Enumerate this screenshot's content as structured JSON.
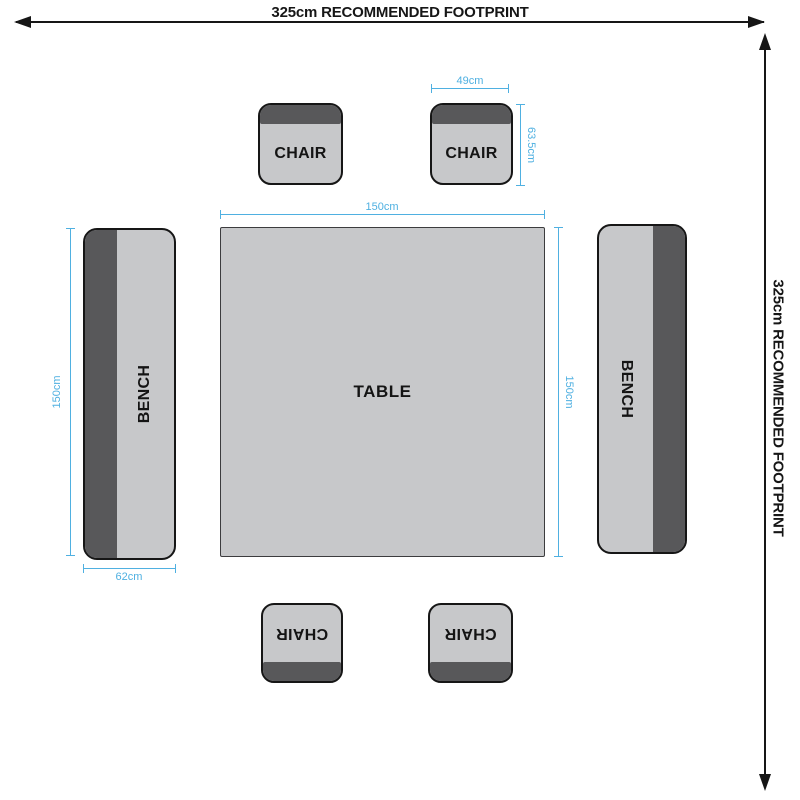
{
  "diagram": {
    "footprint": {
      "top": "325cm RECOMMENDED FOOTPRINT",
      "right": "325cm RECOMMENDED FOOTPRINT"
    },
    "furniture": {
      "table": "TABLE",
      "bench_left": "BENCH",
      "bench_right": "BENCH",
      "chair_top_left": "CHAIR",
      "chair_top_right": "CHAIR",
      "chair_bottom_left": "CHAIR",
      "chair_bottom_right": "CHAIR"
    },
    "dimensions": {
      "chair_width": "49cm",
      "chair_depth": "63.5cm",
      "table_width": "150cm",
      "table_depth": "150cm",
      "bench_length": "150cm",
      "bench_width": "62cm"
    },
    "colors": {
      "furniture_fill": "#c7c8ca",
      "backrest_dark": "#58585a",
      "dimension_blue": "#4fb0e1",
      "outline_black": "#161616"
    }
  }
}
